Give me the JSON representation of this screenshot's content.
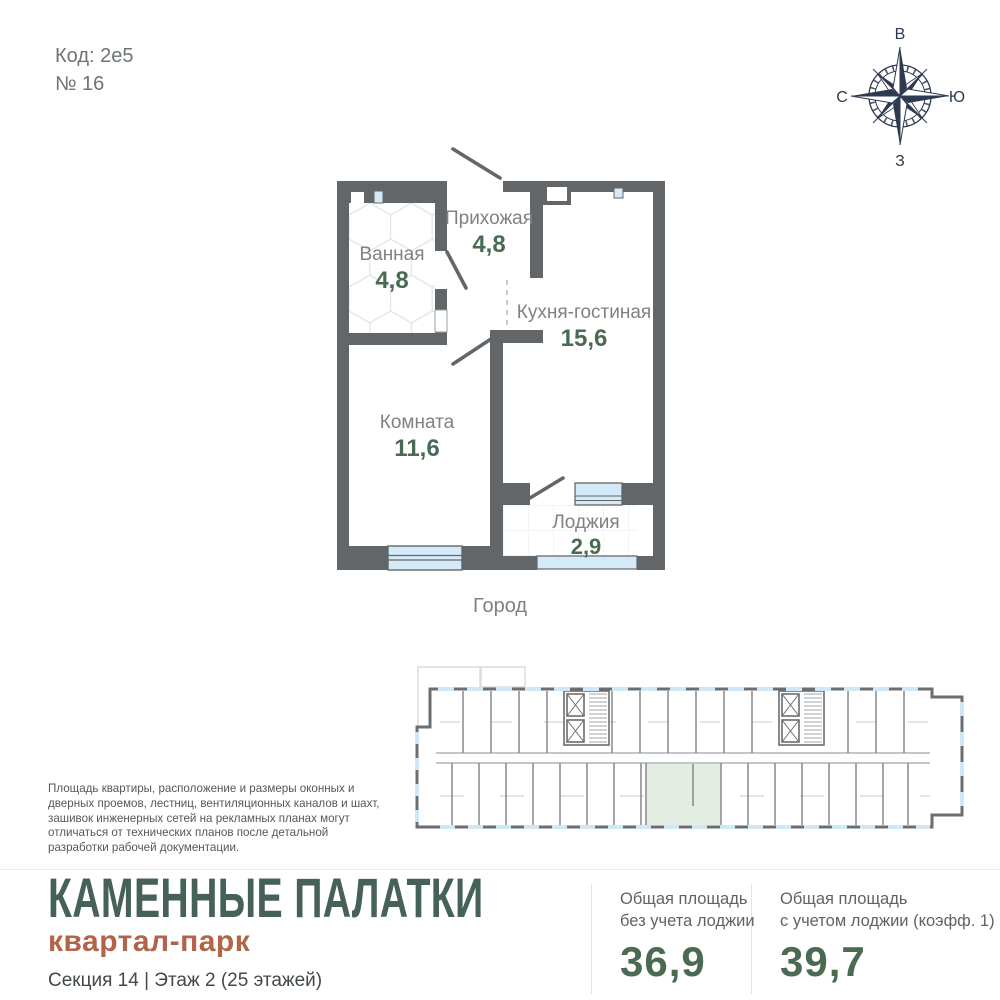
{
  "header": {
    "code": "Код: 2е5",
    "number": "№ 16"
  },
  "compass": {
    "top": "В",
    "right": "Ю",
    "bottom": "З",
    "left": "С"
  },
  "plan": {
    "orientation_label": "Город",
    "rooms": [
      {
        "name": "Ванная",
        "area": "4,8"
      },
      {
        "name": "Прихожая",
        "area": "4,8"
      },
      {
        "name": "Кухня-гостиная",
        "area": "15,6"
      },
      {
        "name": "Комната",
        "area": "11,6"
      },
      {
        "name": "Лоджия",
        "area": "2,9"
      }
    ]
  },
  "disclaimer": "Площадь квартиры, расположение и размеры оконных и дверных проемов, лестниц, вентиляционных каналов и шахт, зашивок инженерных сетей на рекламных планах могут отличаться от технических планов после детальной разработки рабочей документации.",
  "footer": {
    "title": "КАМЕННЫЕ ПАЛАТКИ",
    "subtitle": "квартал-парк",
    "section_info": "Секция 14 | Этаж 2 (25 этажей)",
    "areas": [
      {
        "line1": "Общая площадь",
        "line2": "без учета лоджии",
        "value": "36,9"
      },
      {
        "line1": "Общая площадь",
        "line2": "с учетом лоджии (коэфф. 1)",
        "value": "39,7"
      }
    ]
  },
  "colors": {
    "wall_gray": "#636669",
    "window_blue": "#d4eaf8",
    "accent_green": "#4a6b52",
    "title_green": "#46605a",
    "subtitle_terracotta": "#b26449",
    "highlight_green": "#e3ede2",
    "compass_navy": "#2e3a50"
  }
}
